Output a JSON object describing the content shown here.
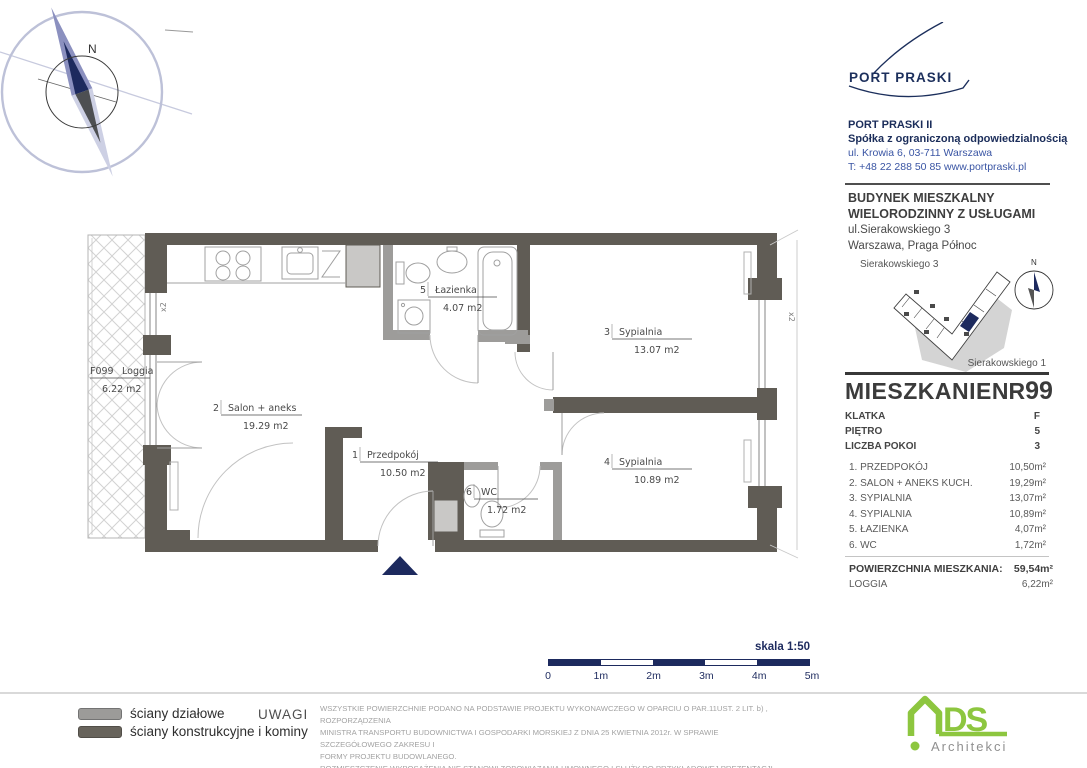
{
  "developer": {
    "logo_text": "PORT PRASKI",
    "company_name": "PORT PRASKI II",
    "company_type": "Spółka z ograniczoną odpowiedzialnością",
    "address": "ul. Krowia 6, 03-711 Warszawa",
    "phone_web": "T:  +48 22 288 50 85   www.portpraski.pl"
  },
  "building": {
    "title_line1": "BUDYNEK MIESZKALNY",
    "title_line2": "WIELORODZINNY Z USŁUGAMI",
    "address": "ul.Sierakowskiego 3",
    "city": "Warszawa, Praga Północ",
    "map_label_top": "Sierakowskiego 3",
    "map_label_bottom": "Sierakowskiego 1"
  },
  "compass": {
    "n": "N"
  },
  "apartment": {
    "title": "MIESZKANIE",
    "nr_label": "NR",
    "number": "99",
    "details": [
      {
        "label": "KLATKA",
        "value": "F"
      },
      {
        "label": "PIĘTRO",
        "value": "5"
      },
      {
        "label": "LICZBA POKOI",
        "value": "3"
      }
    ],
    "rooms": [
      {
        "label": "1. PRZEDPOKÓJ",
        "area": "10,50m²"
      },
      {
        "label": "2. SALON + ANEKS KUCH.",
        "area": "19,29m²"
      },
      {
        "label": "3. SYPIALNIA",
        "area": "13,07m²"
      },
      {
        "label": "4. SYPIALNIA",
        "area": "10,89m²"
      },
      {
        "label": "5. ŁAZIENKA",
        "area": "4,07m²"
      },
      {
        "label": "6. WC",
        "area": "1,72m²"
      }
    ],
    "total_label": "POWIERZCHNIA MIESZKANIA:",
    "total_value": "59,54m²",
    "loggia_label": "LOGGIA",
    "loggia_value": "6,22m²"
  },
  "plan": {
    "rooms": [
      {
        "num": "2",
        "name": "Salon + aneks",
        "area": "19.29  m2"
      },
      {
        "num": "1",
        "name": "Przedpokój",
        "area": "10.50  m2"
      },
      {
        "num": "5",
        "name": "Łazienka",
        "area": "4.07  m2"
      },
      {
        "num": "6",
        "name": "WC",
        "area": "1.72  m2"
      },
      {
        "num": "3",
        "name": "Sypialnia",
        "area": "13.07  m2"
      },
      {
        "num": "4",
        "name": "Sypialnia",
        "area": "10.89  m2"
      }
    ],
    "loggia": {
      "code": "F099",
      "name": "Loggia",
      "area": "6.22  m2"
    },
    "window_label": "x2"
  },
  "scale": {
    "label": "skala 1:50",
    "ticks": [
      "0",
      "1m",
      "2m",
      "3m",
      "4m",
      "5m"
    ]
  },
  "legend": {
    "item1": "ściany działowe",
    "item2": "ściany konstrukcyjne i kominy"
  },
  "notes": {
    "uwagi_label": "UWAGI",
    "text": "WSZYSTKIE POWIERZCHNIE PODANO NA PODSTAWIE PROJEKTU WYKONAWCZEGO W OPARCIU O PAR.11UST. 2 LIT. b) , ROZPORZĄDZENIA\nMINISTRA TRANSPORTU BUDOWNICTWA I GOSPODARKI MORSKIEJ Z DNIA 25 KWIETNIA 2012r. W SPRAWIE SZCZEGÓŁOWEGO ZAKRESU I\nFORMY PROJEKTU BUDOWLANEGO.\nROZMIESZCZENIE WYPOSAŻENIA NIE STANOWI ZOBOWIAZANIA UMOWNEGO I SŁUŻY DO PRZYKŁADOWEJ PREZENTACJI GRAFICZNEJ."
  },
  "architect": {
    "name_big": "DS",
    "name_small": "Architekci"
  },
  "colors": {
    "navy": "#1d2a5e",
    "brand_navy": "#1b2d5a",
    "link_blue": "#3a55a4",
    "wall_dark": "#605c55",
    "wall_light": "#9d9c9a",
    "shaft_gray": "#c9c8c6",
    "ads_green": "#8dc63f"
  }
}
